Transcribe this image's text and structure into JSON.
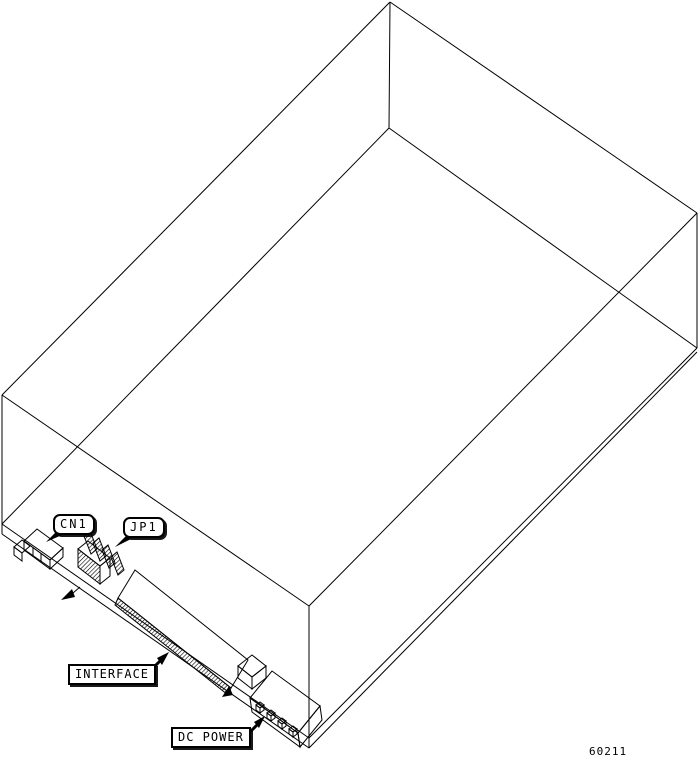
{
  "figure": {
    "type": "technical-wireframe-diagram",
    "subject": "disk drive enclosure, bottom-rear isometric view with connector callouts",
    "part_number": "60211",
    "callouts": {
      "cn1": "CN1",
      "jp1": "JP1",
      "interface": "INTERFACE",
      "dc_power": "DC POWER"
    },
    "colors": {
      "line": "#000000",
      "background": "#ffffff",
      "label_fill": "#ffffff"
    }
  }
}
